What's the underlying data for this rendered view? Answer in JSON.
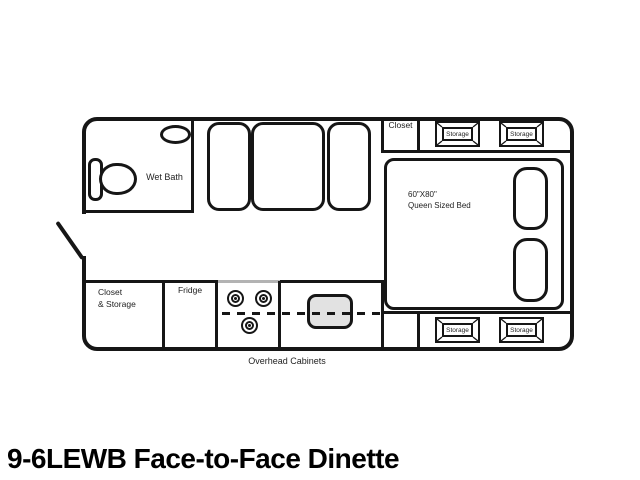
{
  "title": "9-6LEWB Face-to-Face Dinette",
  "floorplan": {
    "wet_bath_label": "Wet Bath",
    "closet_label": "Closet",
    "bed": {
      "size_label": "60\"X80\"",
      "type_label": "Queen Sized Bed"
    },
    "closet_storage_line1": "Closet",
    "closet_storage_line2": "& Storage",
    "fridge_label": "Fridge",
    "overhead_cabinets_label": "Overhead Cabinets",
    "storage_units": [
      {
        "label": "Storage"
      },
      {
        "label": "Storage"
      },
      {
        "label": "Storage"
      },
      {
        "label": "Storage"
      }
    ]
  },
  "colors": {
    "line": "#161616",
    "sink_fill": "#e2e2e2",
    "stove_divider_gray": "#b3b3b3",
    "background": "#ffffff"
  }
}
